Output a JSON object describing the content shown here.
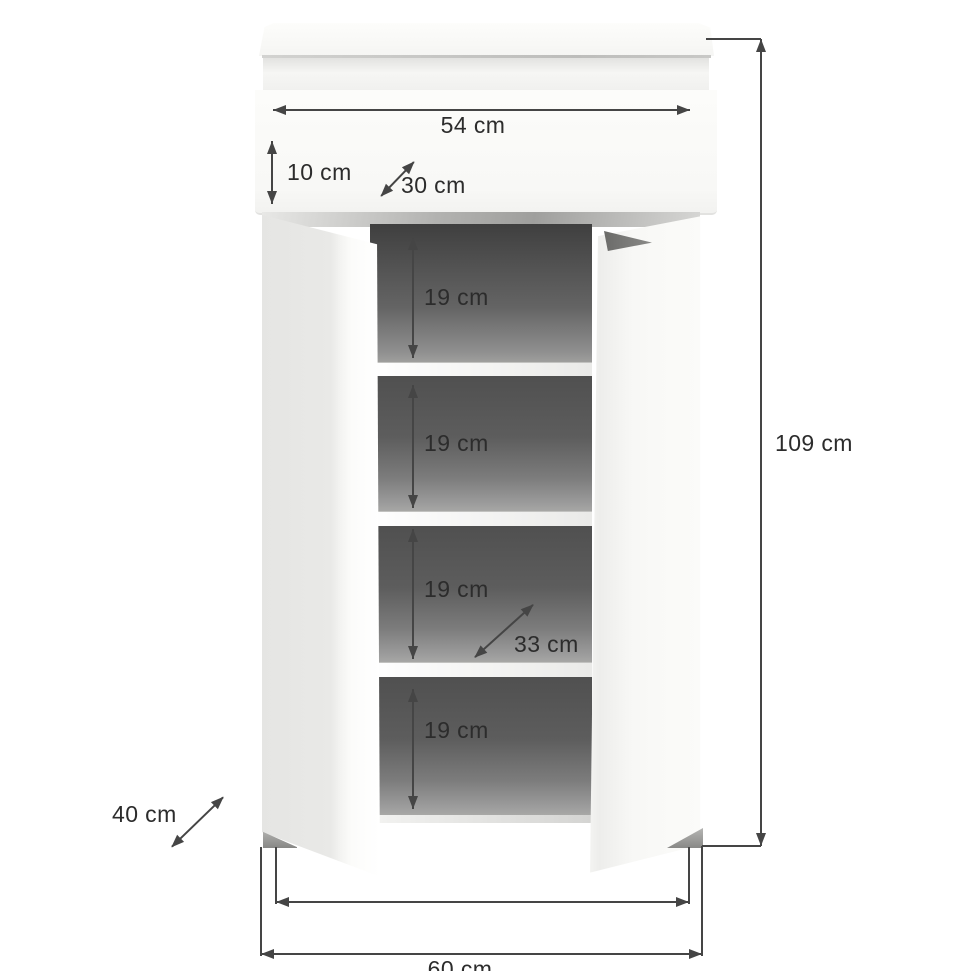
{
  "diagram": {
    "type": "furniture-dimension-diagram",
    "subject": "shoe cabinet with open doors and drawer",
    "dimensions": {
      "top_width": "54 cm",
      "drawer_height": "10 cm",
      "top_depth": "30 cm",
      "compartment_1": "19 cm",
      "compartment_2": "19 cm",
      "compartment_3": "19 cm",
      "compartment_4": "19 cm",
      "shelf_depth": "33 cm",
      "base_depth": "40 cm",
      "total_height": "109 cm",
      "total_width": "60 cm"
    },
    "colors": {
      "background": "#ffffff",
      "dimension_line": "#454545",
      "dimension_text": "#2c2c2c",
      "interior_dark": "#4a4a4a",
      "door_light_gray": "#e8e8e6",
      "cabinet_white": "#fbfbf9"
    }
  }
}
